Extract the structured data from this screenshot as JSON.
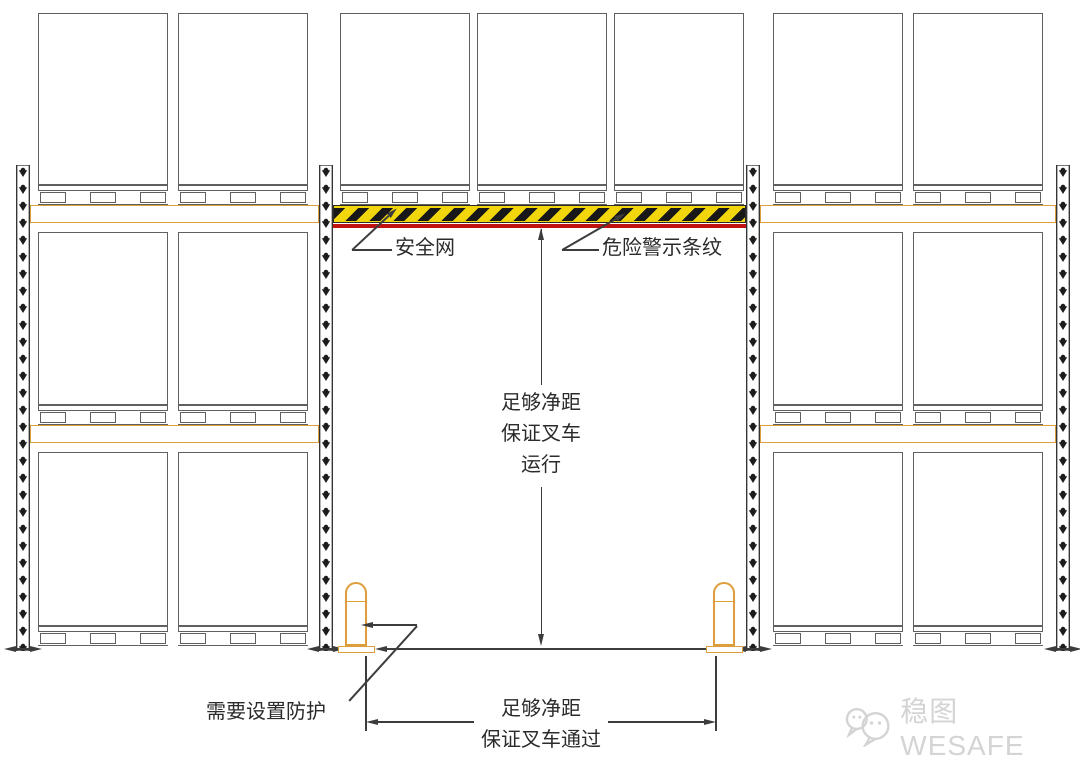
{
  "annotations": {
    "safety_net_label": "安全网",
    "hazard_stripe_label": "危险警示条纹",
    "vertical_clearance": [
      "足够净距",
      "保证叉车",
      "运行"
    ],
    "guard_note_label": "需要设置防护",
    "horizontal_clearance": [
      "足够净距",
      "保证叉车通过"
    ]
  },
  "watermark": {
    "icon": "wechat-icon",
    "text": "稳图WESAFE"
  },
  "colors": {
    "beam_orange": "#DD9F3C",
    "hazard_yellow": "#F2D60C",
    "hazard_black": "#181818",
    "safety_net_red": "#C11212",
    "annotation_line": "#3C3C3C",
    "drawing_line": "#606060",
    "watermark_gray": "#D4D4D4"
  }
}
